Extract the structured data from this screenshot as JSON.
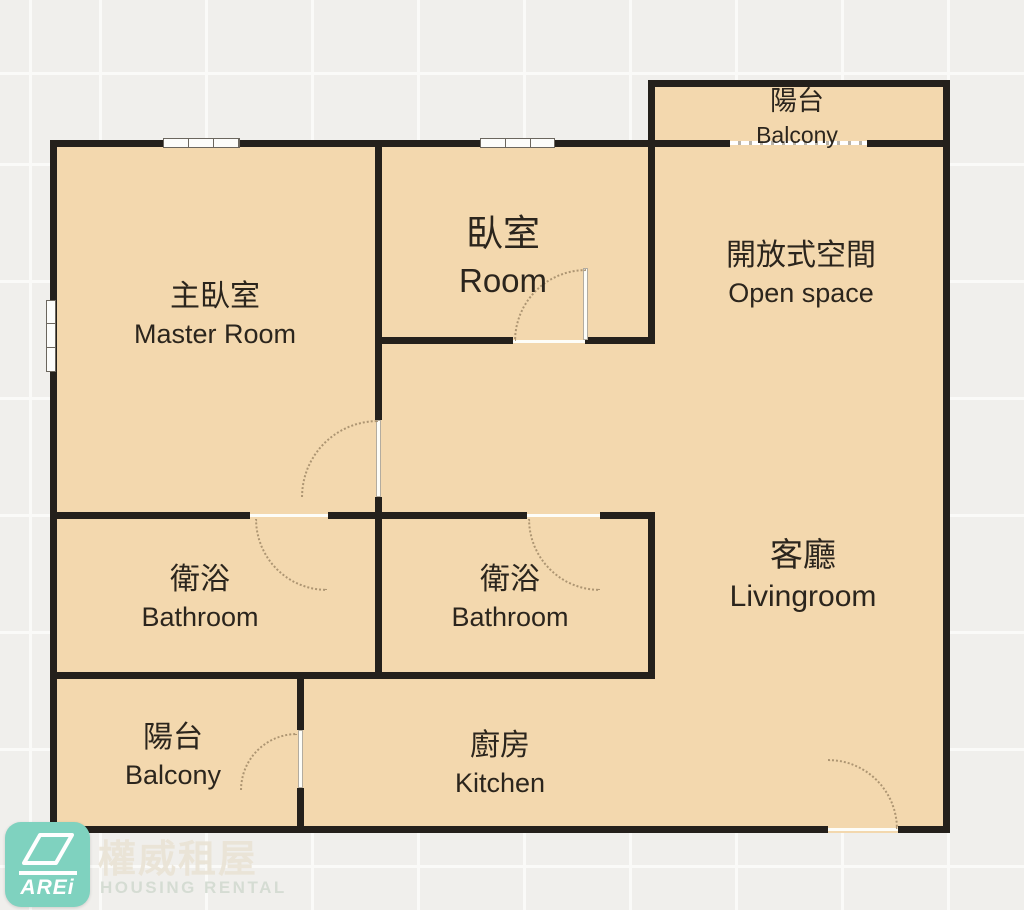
{
  "colors": {
    "floor-fill": "#f3d8ae",
    "wall": "#24201b",
    "bg": "#f0efec",
    "grid-line": "#fafaf8",
    "label": "#2b251d",
    "arc": "#a18a68",
    "logo-teal": "#7fd2bf",
    "watermark-cjk": "#eae3d5",
    "watermark-en": "#d4dcd2"
  },
  "rooms": {
    "balcony_top": {
      "cjk": "陽台",
      "en": "Balcony"
    },
    "open_space": {
      "cjk": "開放式空間",
      "en": "Open space"
    },
    "master": {
      "cjk": "主臥室",
      "en": "Master Room"
    },
    "bedroom": {
      "cjk": "臥室",
      "en": "Room"
    },
    "bathroom_left": {
      "cjk": "衛浴",
      "en": "Bathroom"
    },
    "bathroom_mid": {
      "cjk": "衛浴",
      "en": "Bathroom"
    },
    "livingroom": {
      "cjk": "客廳",
      "en": "Livingroom"
    },
    "balcony_bottom": {
      "cjk": "陽台",
      "en": "Balcony"
    },
    "kitchen": {
      "cjk": "廚房",
      "en": "Kitchen"
    }
  },
  "branding": {
    "logo_text": "AREi",
    "watermark_cjk": "權威租屋",
    "watermark_en": "HOUSING RENTAL"
  }
}
